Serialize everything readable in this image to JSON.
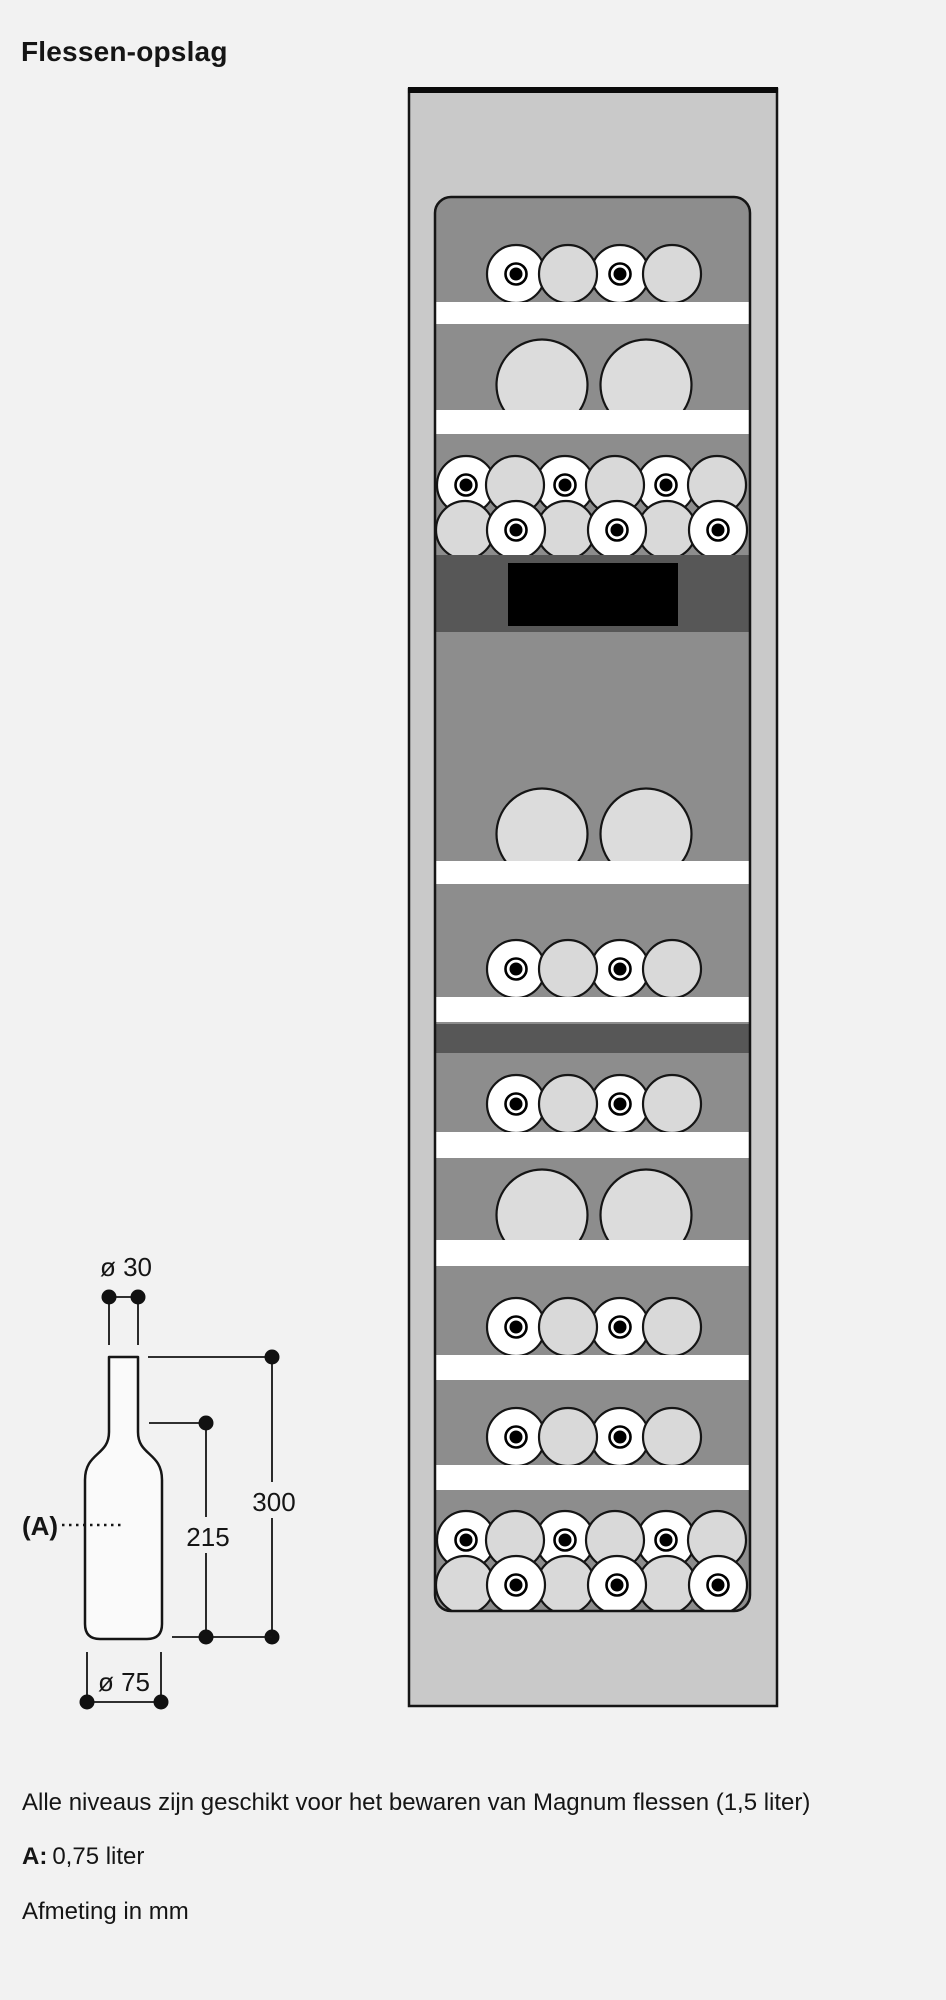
{
  "page": {
    "title": "Flessen-opslag",
    "background": "#f2f2f2",
    "notes": {
      "line1": "Alle niveaus zijn geschikt voor het bewaren van Magnum flessen (1,5 liter)",
      "a_label": "A:",
      "a_value": "0,75 liter",
      "line3": "Afmeting in mm"
    }
  },
  "colors": {
    "outline": "#151515",
    "cabinet_fill": "#c9c9c9",
    "interior_fill": "#8d8d8d",
    "band_fill": "#575757",
    "shelf_fill": "#ffffff",
    "bottle_plain_fill": "#d9d9d9",
    "bottle_cork_fill": "#ffffff",
    "magnum_fill": "#dcdcdc",
    "display_fill": "#000000",
    "top_bar_fill": "#0a0a0a"
  },
  "cabinet": {
    "outer": {
      "x": 409,
      "y": 89,
      "w": 368,
      "h": 1617
    },
    "top_bar_h": 6,
    "interior": {
      "x": 435,
      "y": 197,
      "w": 315,
      "h": 1414,
      "rx": 16
    },
    "small_r": 29,
    "magnum_r": 45.5,
    "bottles4_x": [
      516,
      568,
      620,
      672
    ],
    "magnum_x": [
      542,
      646
    ],
    "double_upper_x": [
      466,
      515,
      565,
      615,
      666,
      717
    ],
    "double_lower_x": [
      465,
      516,
      566,
      617,
      667,
      718
    ],
    "rows": [
      {
        "type": "bottles4",
        "cy": 274,
        "bottles": 4
      },
      {
        "type": "shelf",
        "y": 302,
        "h": 22
      },
      {
        "type": "magnum2",
        "cy": 385,
        "bottles": 2
      },
      {
        "type": "shelf",
        "y": 410,
        "h": 24
      },
      {
        "type": "double",
        "upper_cy": 485,
        "lower_cy": 530,
        "bottles": 12
      },
      {
        "type": "band",
        "y": 555,
        "h": 77,
        "display": {
          "x": 508,
          "y": 563,
          "w": 170,
          "h": 63
        }
      },
      {
        "type": "magnum2",
        "cy": 834,
        "bottles": 2
      },
      {
        "type": "shelf",
        "y": 861,
        "h": 23
      },
      {
        "type": "bottles4",
        "cy": 969,
        "bottles": 4
      },
      {
        "type": "shelf",
        "y": 997,
        "h": 25
      },
      {
        "type": "band",
        "y": 1024,
        "h": 29
      },
      {
        "type": "bottles4",
        "cy": 1104,
        "bottles": 4
      },
      {
        "type": "shelf",
        "y": 1132,
        "h": 26
      },
      {
        "type": "magnum2",
        "cy": 1215,
        "bottles": 2
      },
      {
        "type": "shelf",
        "y": 1240,
        "h": 26
      },
      {
        "type": "bottles4",
        "cy": 1327,
        "bottles": 4
      },
      {
        "type": "shelf",
        "y": 1355,
        "h": 25
      },
      {
        "type": "bottles4",
        "cy": 1437,
        "bottles": 4
      },
      {
        "type": "shelf",
        "y": 1465,
        "h": 25
      },
      {
        "type": "double",
        "upper_cy": 1540,
        "lower_cy": 1585,
        "bottles": 12
      }
    ]
  },
  "dimensions": {
    "neck_diameter": "ø 30",
    "body_diameter": "ø 75",
    "shoulder_height": "215",
    "total_height": "300",
    "bottle_label": "(A)"
  }
}
